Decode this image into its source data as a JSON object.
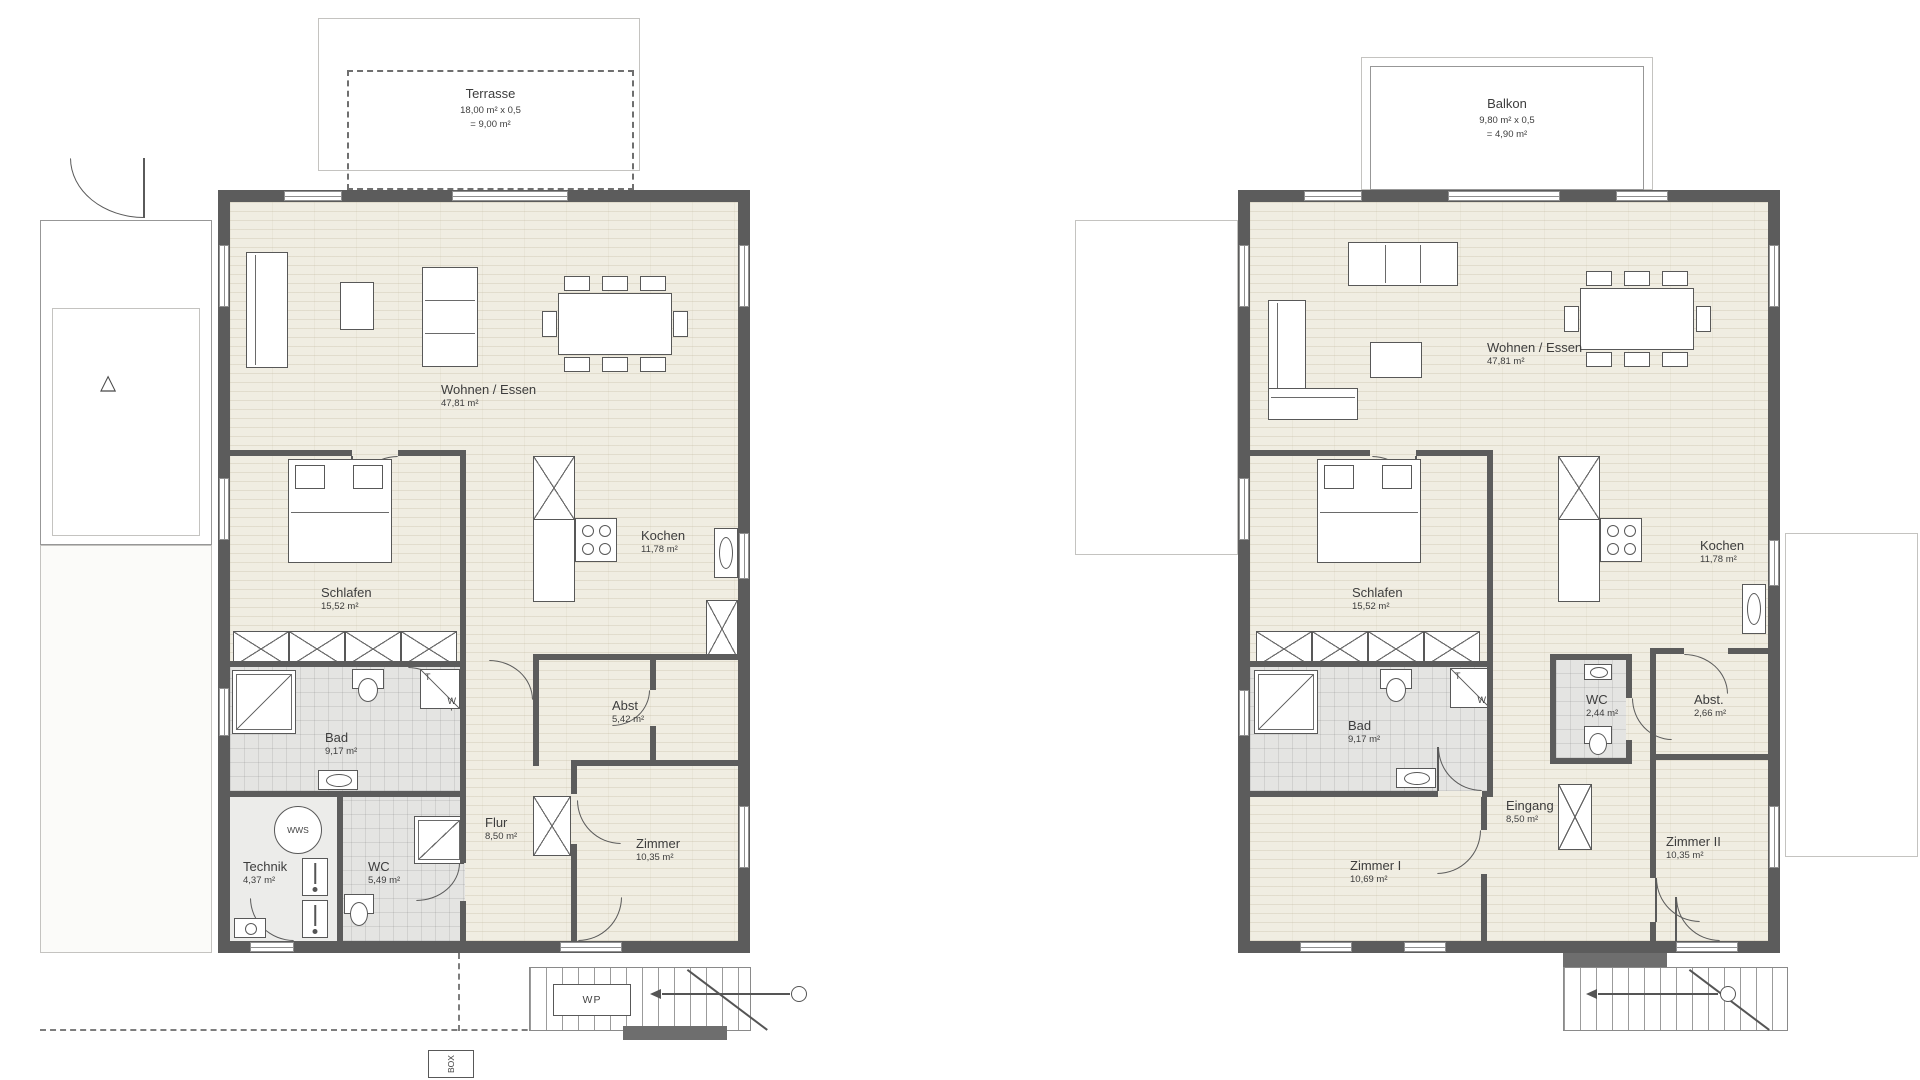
{
  "colors": {
    "wall": "#5c5c5c",
    "floor_living": "#f0ede2",
    "floor_wet": "#e4e4e2",
    "paper": "#ffffff",
    "line": "#585858"
  },
  "icons": {
    "gate_triangle": "△"
  },
  "plans": [
    {
      "terrace": {
        "name": "Terrasse",
        "formula": "18,00 m² x 0,5",
        "result": "= 9,00 m²"
      },
      "rooms": [
        {
          "name": "Wohnen / Essen",
          "area": "47,81 m²"
        },
        {
          "name": "Schlafen",
          "area": "15,52 m²"
        },
        {
          "name": "Kochen",
          "area": "11,78 m²"
        },
        {
          "name": "Bad",
          "area": "9,17 m²"
        },
        {
          "name": "Abst",
          "area": "5,42 m²"
        },
        {
          "name": "Flur",
          "area": "8,50 m²"
        },
        {
          "name": "Technik",
          "area": "4,37 m²"
        },
        {
          "name": "WC",
          "area": "5,49 m²"
        },
        {
          "name": "Zimmer",
          "area": "10,35 m²"
        }
      ],
      "symbols": {
        "tw_t": "T",
        "tw_w": "W",
        "wws": "WWS",
        "wp": "WP",
        "box": "BOX"
      }
    },
    {
      "balcony": {
        "name": "Balkon",
        "formula": "9,80 m² x 0,5",
        "result": "= 4,90 m²"
      },
      "rooms": [
        {
          "name": "Wohnen / Essen",
          "area": "47,81 m²"
        },
        {
          "name": "Schlafen",
          "area": "15,52 m²"
        },
        {
          "name": "Kochen",
          "area": "11,78 m²"
        },
        {
          "name": "Bad",
          "area": "9,17 m²"
        },
        {
          "name": "WC",
          "area": "2,44 m²"
        },
        {
          "name": "Abst.",
          "area": "2,66 m²"
        },
        {
          "name": "Eingang",
          "area": "8,50 m²"
        },
        {
          "name": "Zimmer I",
          "area": "10,69 m²"
        },
        {
          "name": "Zimmer II",
          "area": "10,35 m²"
        }
      ],
      "symbols": {
        "tw_t": "T",
        "tw_w": "W"
      }
    }
  ]
}
